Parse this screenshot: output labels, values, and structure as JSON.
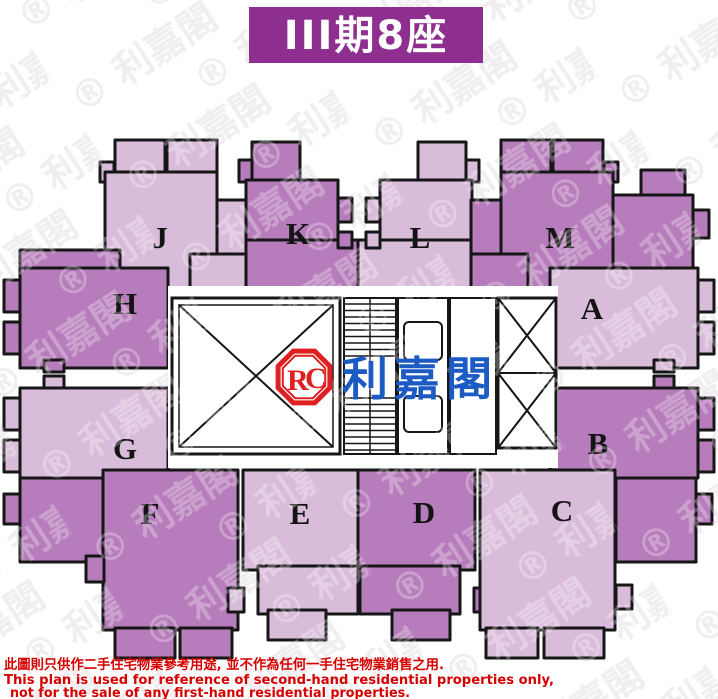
{
  "title": {
    "block_label": "III期8座"
  },
  "watermark": {
    "tile": "® 利嘉閣"
  },
  "logo": {
    "monogram_r": "R",
    "monogram_c": "C",
    "brand_name": "利嘉閣"
  },
  "units": [
    {
      "id": "J",
      "label": "J",
      "shade": "light"
    },
    {
      "id": "K",
      "label": "K",
      "shade": "dark"
    },
    {
      "id": "L",
      "label": "L",
      "shade": "light"
    },
    {
      "id": "M",
      "label": "M",
      "shade": "dark"
    },
    {
      "id": "H",
      "label": "H",
      "shade": "dark"
    },
    {
      "id": "A",
      "label": "A",
      "shade": "light"
    },
    {
      "id": "G",
      "label": "G",
      "shade": "light"
    },
    {
      "id": "B",
      "label": "B",
      "shade": "dark"
    },
    {
      "id": "F",
      "label": "F",
      "shade": "dark"
    },
    {
      "id": "E",
      "label": "E",
      "shade": "light"
    },
    {
      "id": "D",
      "label": "D",
      "shade": "dark"
    },
    {
      "id": "C",
      "label": "C",
      "shade": "light"
    }
  ],
  "disclaimer": {
    "zh": "此圖則只供作二手住宅物業參考用途, 並不作為任何一手住宅物業銷售之用.",
    "en_line1": "This plan is used for reference of second-hand residential properties only,",
    "en_line2": "not for the sale of any first-hand residential properties."
  },
  "colors": {
    "banner": "#8E2F90",
    "unit_light": "#D9BCDA",
    "unit_dark": "#B77CBB",
    "outline": "#161616",
    "disclaimer_red": "#D60000",
    "logo_red": "#E02020",
    "logo_blue": "#1D5BC4",
    "watermark_gray": "#ECE7EC"
  }
}
